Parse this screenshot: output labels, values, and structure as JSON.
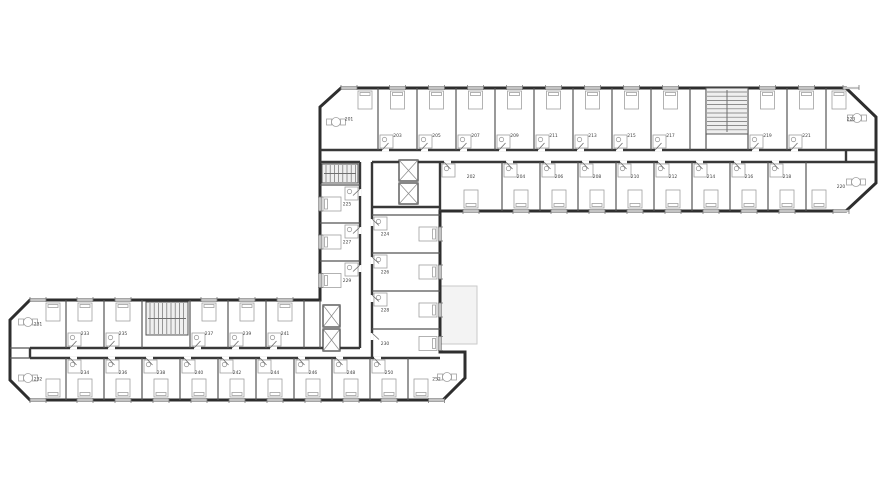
{
  "document": {
    "type": "architectural-floor-plan",
    "floor_label": "2",
    "background": "#ffffff"
  },
  "colors": {
    "outline": "#2e2e2e",
    "wall": "#383838",
    "partition": "#555555",
    "furniture": "#a0a0a0",
    "fixture": "#8a8a8a",
    "stair_fill": "#efefef",
    "stair_line": "#6f6f6f",
    "terrace_fill": "#f3f3f3",
    "terrace_stroke": "#c9c9c9",
    "window": "#c4c4c4",
    "window_tick": "#777777",
    "door": "#6a6a6a",
    "label": "#3f3f3f"
  },
  "floorplan": {
    "canvas": {
      "w": 880,
      "h": 495
    },
    "outline_points": "341,88 846,88 876,117 876,183 846,211 440,211 440,352 465,352 465,378 443,400 30,400 10,380 10,320 30,300 320,300 320,107",
    "terrace": {
      "x": 433,
      "y": 286,
      "w": 44,
      "h": 58
    },
    "walls_main": [
      [
        320,
        150,
        876,
        150
      ],
      [
        440,
        162,
        876,
        162
      ],
      [
        320,
        162,
        360,
        162
      ],
      [
        372,
        162,
        440,
        162
      ],
      [
        846,
        150,
        846,
        162
      ],
      [
        360,
        162,
        360,
        348
      ],
      [
        372,
        162,
        372,
        358
      ],
      [
        372,
        207,
        440,
        207
      ],
      [
        440,
        162,
        440,
        211
      ],
      [
        30,
        348,
        360,
        348
      ],
      [
        30,
        358,
        440,
        358
      ],
      [
        30,
        348,
        30,
        358
      ]
    ],
    "partitions": [
      [
        378,
        88,
        378,
        150
      ],
      [
        417,
        88,
        417,
        150
      ],
      [
        456,
        88,
        456,
        150
      ],
      [
        495,
        88,
        495,
        150
      ],
      [
        534,
        88,
        534,
        150
      ],
      [
        573,
        88,
        573,
        150
      ],
      [
        612,
        88,
        612,
        150
      ],
      [
        651,
        88,
        651,
        150
      ],
      [
        690,
        88,
        690,
        150
      ],
      [
        706,
        88,
        706,
        150
      ],
      [
        748,
        88,
        748,
        150
      ],
      [
        787,
        88,
        787,
        150
      ],
      [
        826,
        88,
        826,
        150
      ],
      [
        502,
        162,
        502,
        211
      ],
      [
        540,
        162,
        540,
        211
      ],
      [
        578,
        162,
        578,
        211
      ],
      [
        616,
        162,
        616,
        211
      ],
      [
        654,
        162,
        654,
        211
      ],
      [
        692,
        162,
        692,
        211
      ],
      [
        730,
        162,
        730,
        211
      ],
      [
        768,
        162,
        768,
        211
      ],
      [
        806,
        162,
        806,
        211
      ],
      [
        320,
        185,
        360,
        185
      ],
      [
        320,
        223,
        360,
        223
      ],
      [
        320,
        261,
        360,
        261
      ],
      [
        372,
        215,
        440,
        215
      ],
      [
        372,
        253,
        440,
        253
      ],
      [
        372,
        291,
        440,
        291
      ],
      [
        372,
        329,
        440,
        329
      ],
      [
        66,
        300,
        66,
        348
      ],
      [
        104,
        300,
        104,
        348
      ],
      [
        142,
        300,
        142,
        348
      ],
      [
        190,
        300,
        190,
        348
      ],
      [
        228,
        300,
        228,
        348
      ],
      [
        266,
        300,
        266,
        348
      ],
      [
        304,
        300,
        304,
        348
      ],
      [
        320,
        300,
        320,
        348
      ],
      [
        66,
        358,
        66,
        400
      ],
      [
        104,
        358,
        104,
        400
      ],
      [
        142,
        358,
        142,
        400
      ],
      [
        180,
        358,
        180,
        400
      ],
      [
        218,
        358,
        218,
        400
      ],
      [
        256,
        358,
        256,
        400
      ],
      [
        294,
        358,
        294,
        400
      ],
      [
        332,
        358,
        332,
        400
      ],
      [
        370,
        358,
        370,
        400
      ],
      [
        408,
        358,
        408,
        400
      ],
      [
        10,
        348,
        30,
        348
      ],
      [
        10,
        358,
        30,
        358
      ]
    ],
    "stairs": [
      {
        "x": 706,
        "y": 88,
        "w": 42,
        "h": 46,
        "dir": "h"
      },
      {
        "x": 146,
        "y": 302,
        "w": 42,
        "h": 33,
        "dir": "v"
      },
      {
        "x": 322,
        "y": 164,
        "w": 36,
        "h": 19,
        "dir": "v"
      }
    ],
    "elevators": [
      {
        "x": 399,
        "y": 160,
        "w": 19,
        "h": 21
      },
      {
        "x": 399,
        "y": 183,
        "w": 19,
        "h": 21
      },
      {
        "x": 323,
        "y": 305,
        "w": 17,
        "h": 22
      },
      {
        "x": 323,
        "y": 329,
        "w": 17,
        "h": 22
      }
    ],
    "rooms": [
      {
        "n": "201",
        "x": 320,
        "y": 88,
        "w": 58,
        "h": 62,
        "side": "top",
        "t": 1,
        "tx": 336,
        "ty": 122
      },
      {
        "n": "203",
        "x": 378,
        "y": 88,
        "w": 39,
        "h": 62,
        "side": "top"
      },
      {
        "n": "205",
        "x": 417,
        "y": 88,
        "w": 39,
        "h": 62,
        "side": "top"
      },
      {
        "n": "207",
        "x": 456,
        "y": 88,
        "w": 39,
        "h": 62,
        "side": "top"
      },
      {
        "n": "209",
        "x": 495,
        "y": 88,
        "w": 39,
        "h": 62,
        "side": "top"
      },
      {
        "n": "211",
        "x": 534,
        "y": 88,
        "w": 39,
        "h": 62,
        "side": "top"
      },
      {
        "n": "213",
        "x": 573,
        "y": 88,
        "w": 39,
        "h": 62,
        "side": "top"
      },
      {
        "n": "215",
        "x": 612,
        "y": 88,
        "w": 39,
        "h": 62,
        "side": "top"
      },
      {
        "n": "217",
        "x": 651,
        "y": 88,
        "w": 39,
        "h": 62,
        "side": "top"
      },
      {
        "n": "219",
        "x": 748,
        "y": 88,
        "w": 39,
        "h": 62,
        "side": "top"
      },
      {
        "n": "221",
        "x": 787,
        "y": 88,
        "w": 39,
        "h": 62,
        "side": "top"
      },
      {
        "n": "223",
        "x": 826,
        "y": 88,
        "w": 50,
        "h": 62,
        "side": "top",
        "t": 1,
        "tx": 857,
        "ty": 118
      },
      {
        "n": "202",
        "x": 440,
        "y": 162,
        "w": 62,
        "h": 49,
        "side": "bottom"
      },
      {
        "n": "204",
        "x": 502,
        "y": 162,
        "w": 38,
        "h": 49,
        "side": "bottom"
      },
      {
        "n": "206",
        "x": 540,
        "y": 162,
        "w": 38,
        "h": 49,
        "side": "bottom"
      },
      {
        "n": "208",
        "x": 578,
        "y": 162,
        "w": 38,
        "h": 49,
        "side": "bottom"
      },
      {
        "n": "210",
        "x": 616,
        "y": 162,
        "w": 38,
        "h": 49,
        "side": "bottom"
      },
      {
        "n": "212",
        "x": 654,
        "y": 162,
        "w": 38,
        "h": 49,
        "side": "bottom"
      },
      {
        "n": "214",
        "x": 692,
        "y": 162,
        "w": 38,
        "h": 49,
        "side": "bottom"
      },
      {
        "n": "216",
        "x": 730,
        "y": 162,
        "w": 38,
        "h": 49,
        "side": "bottom"
      },
      {
        "n": "218",
        "x": 768,
        "y": 162,
        "w": 38,
        "h": 49,
        "side": "bottom"
      },
      {
        "n": "220",
        "x": 806,
        "y": 162,
        "w": 70,
        "h": 49,
        "side": "bottom",
        "t": 1,
        "tx": 856,
        "ty": 182
      },
      {
        "n": "225",
        "x": 320,
        "y": 185,
        "w": 40,
        "h": 38,
        "side": "left"
      },
      {
        "n": "227",
        "x": 320,
        "y": 223,
        "w": 40,
        "h": 38,
        "side": "left"
      },
      {
        "n": "229",
        "x": 320,
        "y": 261,
        "w": 40,
        "h": 39,
        "side": "left"
      },
      {
        "n": "224",
        "x": 372,
        "y": 215,
        "w": 68,
        "h": 38,
        "side": "right"
      },
      {
        "n": "226",
        "x": 372,
        "y": 253,
        "w": 68,
        "h": 38,
        "side": "right"
      },
      {
        "n": "228",
        "x": 372,
        "y": 291,
        "w": 68,
        "h": 38,
        "side": "right"
      },
      {
        "n": "230",
        "x": 372,
        "y": 329,
        "w": 68,
        "h": 29,
        "side": "right"
      },
      {
        "n": "231",
        "x": 10,
        "y": 300,
        "w": 56,
        "h": 48,
        "side": "top",
        "t": 1,
        "tx": 28,
        "ty": 322
      },
      {
        "n": "233",
        "x": 66,
        "y": 300,
        "w": 38,
        "h": 48,
        "side": "top"
      },
      {
        "n": "235",
        "x": 104,
        "y": 300,
        "w": 38,
        "h": 48,
        "side": "top"
      },
      {
        "n": "237",
        "x": 190,
        "y": 300,
        "w": 38,
        "h": 48,
        "side": "top"
      },
      {
        "n": "239",
        "x": 228,
        "y": 300,
        "w": 38,
        "h": 48,
        "side": "top"
      },
      {
        "n": "241",
        "x": 266,
        "y": 300,
        "w": 38,
        "h": 48,
        "side": "top"
      },
      {
        "n": "232",
        "x": 10,
        "y": 358,
        "w": 56,
        "h": 42,
        "side": "bottom",
        "t": 1,
        "tx": 28,
        "ty": 378
      },
      {
        "n": "234",
        "x": 66,
        "y": 358,
        "w": 38,
        "h": 42,
        "side": "bottom"
      },
      {
        "n": "236",
        "x": 104,
        "y": 358,
        "w": 38,
        "h": 42,
        "side": "bottom"
      },
      {
        "n": "238",
        "x": 142,
        "y": 358,
        "w": 38,
        "h": 42,
        "side": "bottom"
      },
      {
        "n": "240",
        "x": 180,
        "y": 358,
        "w": 38,
        "h": 42,
        "side": "bottom"
      },
      {
        "n": "242",
        "x": 218,
        "y": 358,
        "w": 38,
        "h": 42,
        "side": "bottom"
      },
      {
        "n": "244",
        "x": 256,
        "y": 358,
        "w": 38,
        "h": 42,
        "side": "bottom"
      },
      {
        "n": "246",
        "x": 294,
        "y": 358,
        "w": 38,
        "h": 42,
        "side": "bottom"
      },
      {
        "n": "248",
        "x": 332,
        "y": 358,
        "w": 38,
        "h": 42,
        "side": "bottom"
      },
      {
        "n": "250",
        "x": 370,
        "y": 358,
        "w": 38,
        "h": 42,
        "side": "bottom"
      },
      {
        "n": "252",
        "x": 408,
        "y": 358,
        "w": 57,
        "h": 42,
        "side": "bottom",
        "t": 1,
        "tx": 447,
        "ty": 377
      }
    ]
  }
}
